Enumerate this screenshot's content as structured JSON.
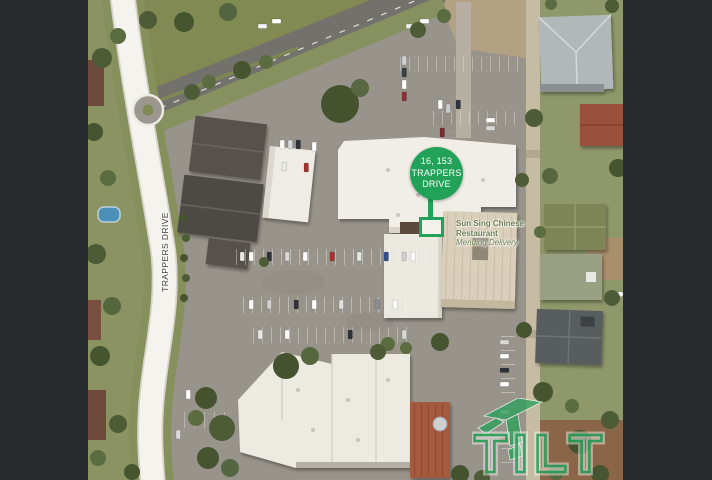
{
  "frame": {
    "background": "#282b2e"
  },
  "map": {
    "pin": {
      "lines": [
        "16, 153",
        "TRAPPERS",
        "DRIVE"
      ],
      "color": "#22a258"
    },
    "road_label": "TRAPPERS DRIVE",
    "poi": {
      "line1": "Sun Sing Chinese",
      "line2": "Restaurant",
      "line3": "Menulog Delivery",
      "color": "#6b7d52"
    },
    "watermark": {
      "text": "TILT",
      "color": "#27a259"
    }
  }
}
